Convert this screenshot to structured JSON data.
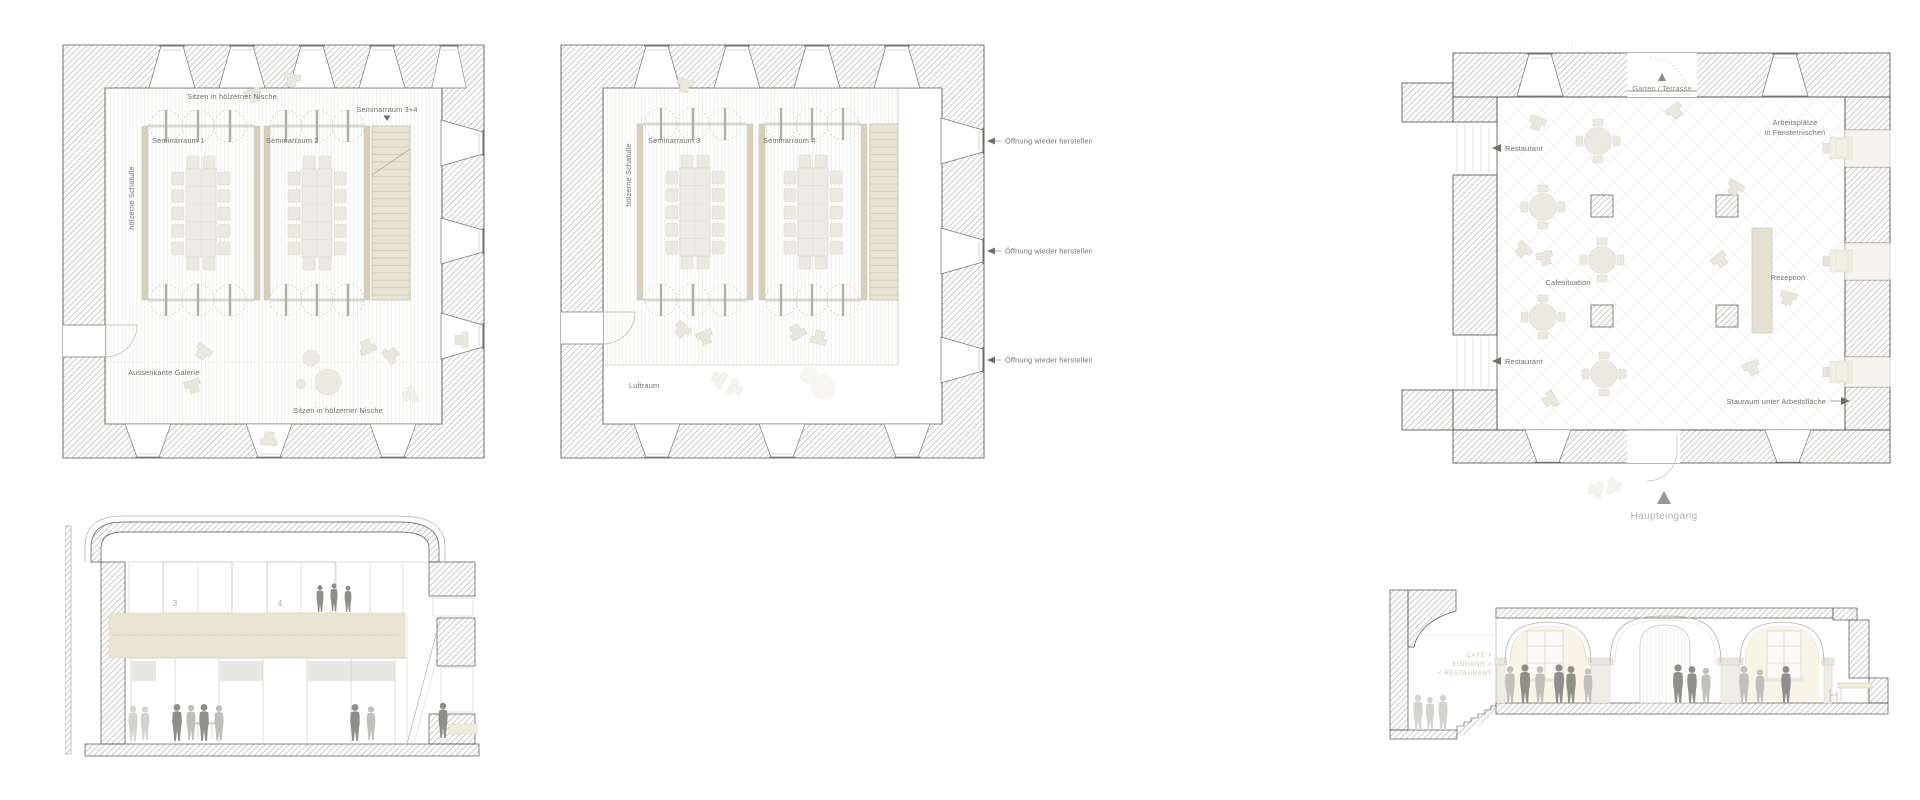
{
  "board": {
    "title": "Architekturplaene Seminarhaus",
    "colors": {
      "background": "#ffffff",
      "wall_line": "#55534d",
      "hatch_line": "#a3a19a",
      "room_wall_beige": "#d7cfb9",
      "slab_beige": "#ece4d2",
      "stair_beige": "#e9e3d3",
      "furniture": "#eceae0",
      "label_gray": "#73726c",
      "label_light": "#b4b3ab",
      "wall_text": "#cdc6b0",
      "people_dark": "#8e8e8b"
    }
  },
  "plan1": {
    "labels": {
      "niche": "Sitzen in hölzerner Nische",
      "seminar34": "Seminarraum 3+4",
      "room1": "Seminarraum 1",
      "room2": "Seminarraum 2",
      "schatulle": "hölzerne Schatulle",
      "galerie": "Aussenkante Galerie"
    }
  },
  "plan2": {
    "labels": {
      "room3": "Seminarraum 3",
      "room4": "Seminarraum 4",
      "schatulle": "hölzerne Schatulle",
      "oeffnung": "Öffnung wieder herstellen",
      "luftraum": "Luftraum"
    }
  },
  "plan3": {
    "labels": {
      "garten": "Garten / Terrasse",
      "arbeitsplaetze1": "Arbeitsplätze",
      "arbeitsplaetze2": "in Fensternischen",
      "restaurant": "Restaurant",
      "cafesituation": "Cafesituation",
      "rezeption": "Rezeption",
      "stauraum": "Stauraum unter Arbeitsfläche",
      "haupteingang": "Haupteingang"
    }
  },
  "section1": {
    "labels": {
      "panel3": "3",
      "panel4": "4"
    }
  },
  "section2": {
    "labels": {
      "cafe": "CAFÉ >",
      "eingang": "EINGANG >",
      "restaurant": "< RESTAURANT"
    }
  }
}
